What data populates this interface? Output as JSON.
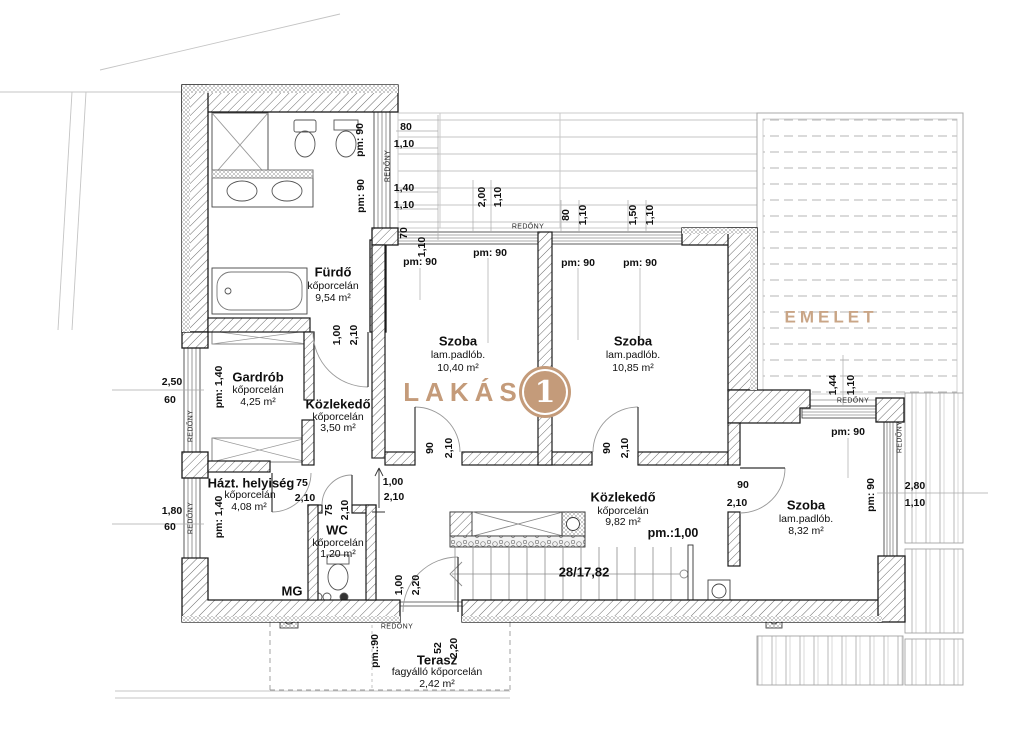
{
  "plan": {
    "unit_label": "LAKÁS",
    "unit_number": "1",
    "upper_floor_label": "EMELET",
    "shutter_label": "REDŐNY",
    "accent_color": "#c49b7a",
    "mg_label": "MG",
    "stair_label": "28/17,82",
    "parapet_100": "pm.:1,00",
    "pm90": "pm: 90",
    "pm90_dot": "pm.:90",
    "pm140": "pm: 1,40"
  },
  "rooms": {
    "furdo": {
      "name": "Fürdő",
      "finish": "kőporcelán",
      "area": "9,54 m²"
    },
    "gardrob": {
      "name": "Gardrób",
      "finish": "kőporcelán",
      "area": "4,25 m²"
    },
    "kozlekedo_small": {
      "name": "Közlekedő",
      "finish": "kőporcelán",
      "area": "3,50 m²"
    },
    "hazt": {
      "name": "Házt. helyiség",
      "finish": "kőporcelán",
      "area": "4,08 m²"
    },
    "wc": {
      "name": "WC",
      "finish": "kőporcelán",
      "area": "1,20 m²"
    },
    "szoba1": {
      "name": "Szoba",
      "finish": "lam.padlób.",
      "area": "10,40 m²"
    },
    "szoba2": {
      "name": "Szoba",
      "finish": "lam.padlób.",
      "area": "10,85 m²"
    },
    "szoba3": {
      "name": "Szoba",
      "finish": "lam.padlób.",
      "area": "8,32 m²"
    },
    "kozlekedo_main": {
      "name": "Közlekedő",
      "finish": "kőporcelán",
      "area": "9,82 m²"
    },
    "terasz": {
      "name": "Terasz",
      "finish": "fagyálló kőporcelán",
      "area": "2,42 m²"
    }
  },
  "dims": {
    "v52": "52",
    "v60": "60",
    "v70": "70",
    "v75": "75",
    "v80": "80",
    "v90": "90",
    "v100": "1,00",
    "v110": "1,10",
    "v140": "1,40",
    "v144": "1,44",
    "v150": "1,50",
    "v180": "1,80",
    "v200": "2,00",
    "v210": "2,10",
    "v220": "2,20",
    "v250": "2,50",
    "v280": "2,80"
  }
}
